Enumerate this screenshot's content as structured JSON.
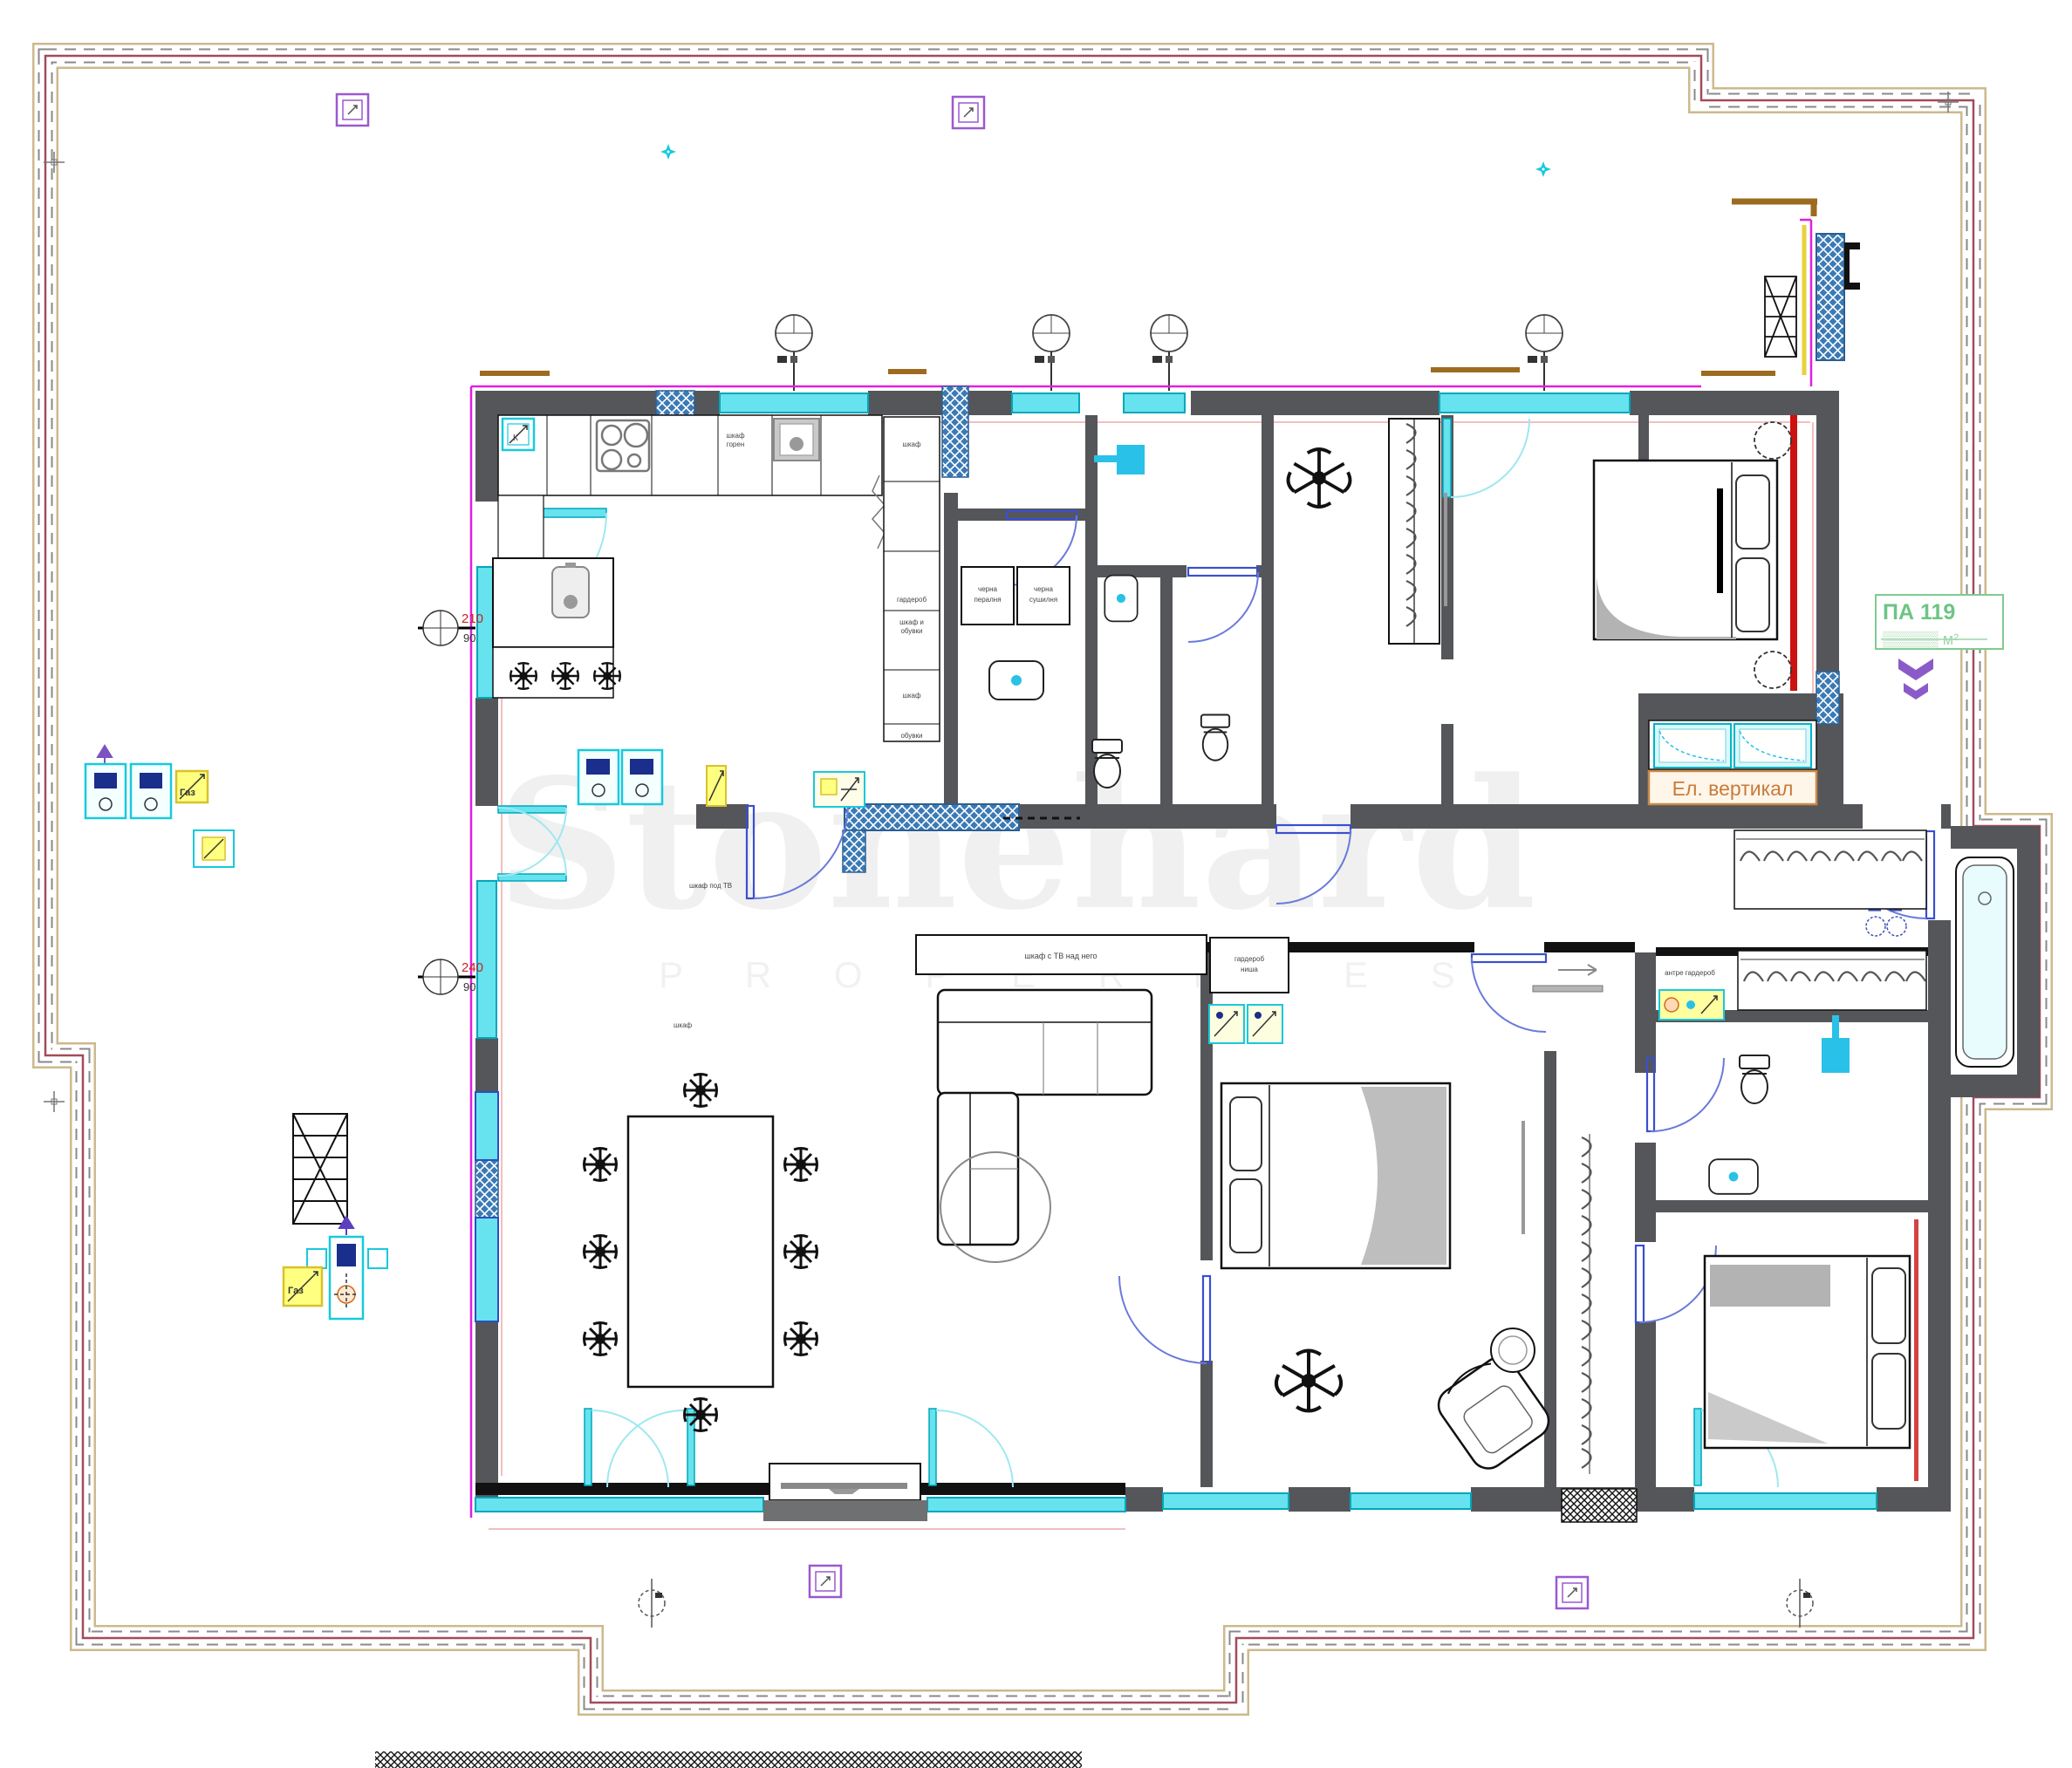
{
  "plan": {
    "unit_label": {
      "code": "ПА 119",
      "area": "▒▒▒▒▒ м²"
    },
    "shaft_label": "Ел. вертикал",
    "door_spec": {
      "width": "В-100",
      "height": "Н-100"
    },
    "dim_marker_1": {
      "main": "210",
      "sub": "90"
    },
    "dim_marker_2": {
      "main": "240",
      "sub": "90"
    },
    "watermark": {
      "brand": "Stonehard",
      "tagline": "P R O P E R T I E S"
    },
    "electrical": {
      "gas_label_1": "Газ",
      "gas_label_2": "Газ",
      "corner_label": "К"
    },
    "furniture_labels": {
      "cabinet_1": "шкаф",
      "cabinet_2": "гардероб",
      "cabinet_3a": "шкаф и",
      "cabinet_3b": "обувки",
      "cabinet_4": "шкаф",
      "cabinet_5": "обувки",
      "washer_a": "черна",
      "washer_b": "пералня",
      "dryer_a": "черна",
      "dryer_b": "сушилня",
      "kitchen_a": "шкаф",
      "kitchen_b": "горен",
      "tv_shelf": "шкаф с ТВ над него",
      "wardrobe_a": "гардероб",
      "wardrobe_b": "ниша",
      "hall_closet": "антре гардероб",
      "under_tv": "шкаф под ТВ",
      "sideboard": "шкаф"
    },
    "colors": {
      "wall": "#55565a",
      "window": "#66e3ee",
      "accent_red": "#cc1111",
      "hatch_blue": "#3b7ab5",
      "boundary_maroon": "#a34b5a",
      "label_green": "#7fcb8f",
      "shaft_orange": "#c87b3a",
      "spec_blue": "#3f51b5"
    }
  }
}
